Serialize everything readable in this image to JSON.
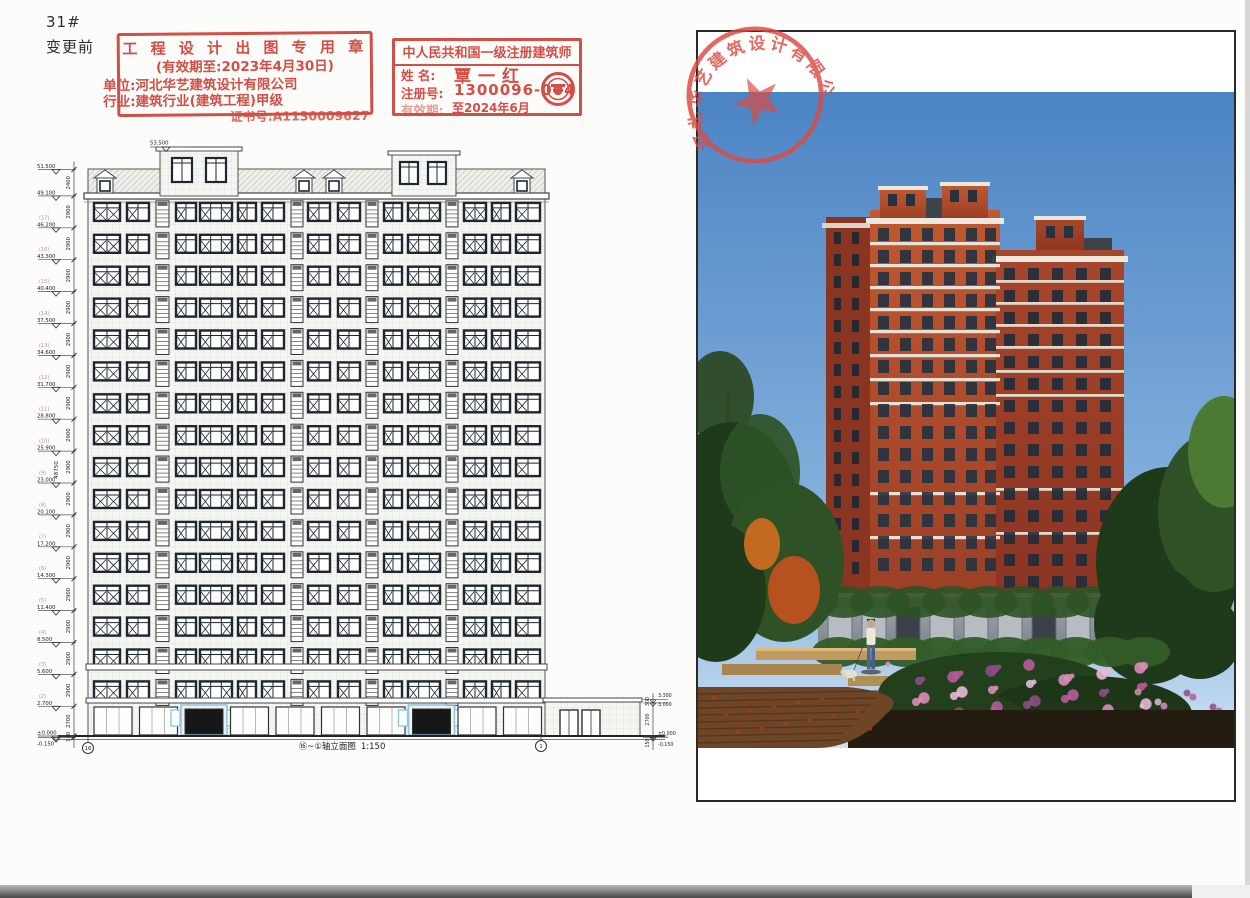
{
  "sheet": {
    "drawing_no": "31#",
    "revision_label": "变更前"
  },
  "design_stamp": {
    "title": "工 程 设 计 出 图 专 用 章",
    "validity": "(有效期至:2023年4月30日)",
    "unit": "单位:河北华艺建筑设计有限公司",
    "industry": "行业:建筑行业(建筑工程)甲级",
    "cert_no": "证书号:A1130009627",
    "color": "#cf4238"
  },
  "architect_stamp": {
    "title": "中人民共和国一级注册建筑师",
    "name_label": "姓 名:",
    "name": "覃一红",
    "reg_label": "注册号:",
    "reg_no": "1300096-004",
    "valid_label": "有效期:",
    "valid_until": "至2024年6月",
    "color": "#cf4238"
  },
  "company_seal": {
    "company": "河北华艺建筑设计有限公司",
    "color": "#dd4a40"
  },
  "elevation": {
    "title": "⑯~①轴立面图",
    "scale": "1:150",
    "axis_left": "16",
    "axis_right": "1",
    "tower_top_level": "53.500",
    "levels": [
      {
        "value": "51.500"
      },
      {
        "value": "49.100"
      },
      {
        "value": "46.200",
        "floor": "(17)"
      },
      {
        "value": "43.300",
        "floor": "(16)"
      },
      {
        "value": "40.400",
        "floor": "(15)"
      },
      {
        "value": "37.500",
        "floor": "(14)"
      },
      {
        "value": "34.600",
        "floor": "(13)"
      },
      {
        "value": "31.700",
        "floor": "(12)"
      },
      {
        "value": "28.800",
        "floor": "(11)"
      },
      {
        "value": "25.900",
        "floor": "(10)"
      },
      {
        "value": "23.000",
        "floor": "(9)"
      },
      {
        "value": "20.100",
        "floor": "(8)"
      },
      {
        "value": "17.200",
        "floor": "(7)"
      },
      {
        "value": "14.300",
        "floor": "(6)"
      },
      {
        "value": "11.400",
        "floor": "(5)"
      },
      {
        "value": "8.500",
        "floor": "(4)"
      },
      {
        "value": "5.600",
        "floor": "(3)"
      },
      {
        "value": "2.700",
        "floor": "(2)"
      },
      {
        "value": "±0.000"
      },
      {
        "value": "-0.150"
      }
    ],
    "floor_height_dim": "2900",
    "top_dim": "2400",
    "ground_dim": "2700",
    "base_dim": "150",
    "total_dim": "48750",
    "annex": {
      "levels": [
        "3.300",
        "3.000",
        "±0.000",
        "-0.150"
      ],
      "dims": [
        "300",
        "2700",
        "150"
      ]
    }
  },
  "rendering_palette": {
    "sky_top": "#4b84c4",
    "sky_bottom": "#cfe2f2",
    "brick_light": "#c1582f",
    "brick_dark": "#8a3422",
    "trim": "#ece8de",
    "roof_slate": "#3f444b",
    "stone_base": "#939aa1",
    "foliage_dark": "#1f3a1a",
    "foliage_mid": "#2e5226",
    "flower_pink": "#d98cb8",
    "flower_magenta": "#b75b9b",
    "deck_wood": "#6e4526",
    "planter_sand": "#c09a5e"
  }
}
